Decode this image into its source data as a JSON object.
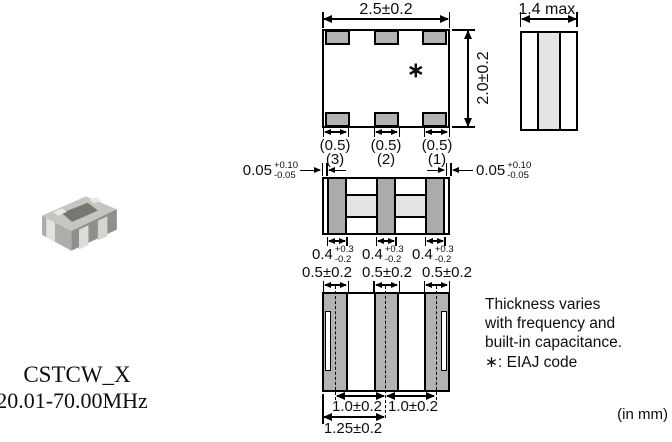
{
  "part": {
    "name": "CSTCW_X",
    "frequency_range": "20.01-70.00MHz"
  },
  "units_note": "(in mm)",
  "notes": {
    "lines": [
      "Thickness varies",
      "with frequency and",
      "built-in capacitance.",
      "∗: EIAJ code"
    ]
  },
  "views": {
    "top": {
      "width_dim": "2.5±0.2",
      "height_dim": "2.0±0.2",
      "eiaj_mark": "∗",
      "pad_width_labels": [
        "(0.5)",
        "(0.5)",
        "(0.5)"
      ]
    },
    "side": {
      "width_dim": "1.4 max."
    },
    "electrode": {
      "terminal_numbers": [
        "(3)",
        "(2)",
        "(1)"
      ],
      "edge_gap": {
        "value": "0.05",
        "plus": "+0.10",
        "minus": "-0.05"
      },
      "electrode_width": {
        "value": "0.4",
        "plus": "+0.3",
        "minus": "-0.2"
      }
    },
    "bottom": {
      "pad_width_dims": [
        "0.5±0.2",
        "0.5±0.2",
        "0.5±0.2"
      ],
      "pitch_dims": [
        "1.0±0.2",
        "1.0±0.2"
      ],
      "edge_to_center_dim": "1.25±0.2"
    }
  },
  "colors": {
    "pad_gray": "#b3b3b3",
    "bar_gray": "#ababab",
    "film_gray": "#e4e4e4",
    "line_black": "#000000"
  }
}
